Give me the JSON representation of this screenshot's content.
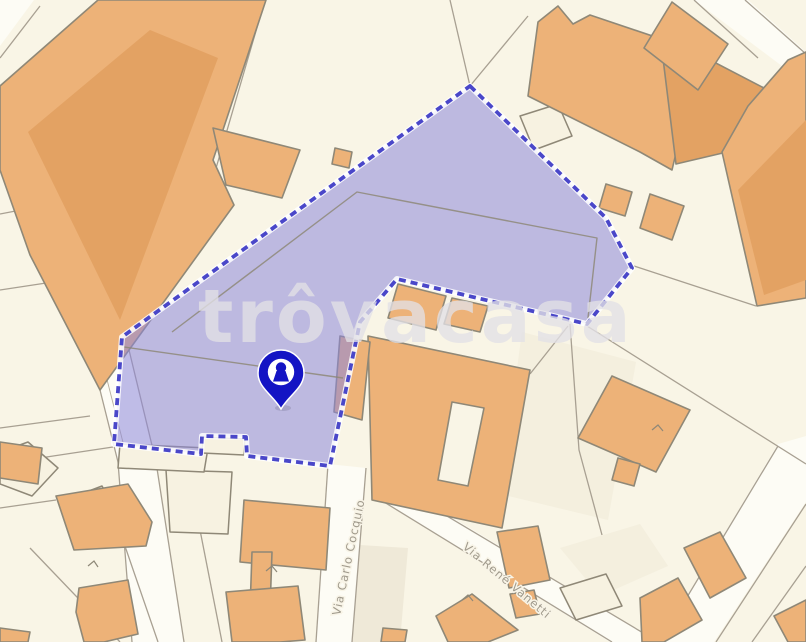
{
  "map": {
    "watermark": {
      "text": "trôvacasa"
    },
    "streets": [
      {
        "name": "Via Carlo Cocquio"
      },
      {
        "name": "Via René Vanetti"
      }
    ],
    "marker": {
      "type": "property-location",
      "icon": "keyhole-icon"
    },
    "parcel": {
      "status": "selected",
      "shape": "dashed-outline"
    },
    "colors": {
      "background": "#f9f5e6",
      "road": "#fdfcf5",
      "building": "#edb278",
      "building_dark": "#e3a263",
      "building_outline": "#8f8877",
      "parcel_line": "#a8a092",
      "parcel_fill": "rgba(140,135,218,0.55)",
      "parcel_border": "#4a47c9",
      "pin": "#1414c4",
      "street_label": "#a09a8c",
      "watermark": "#e3e1e6"
    }
  }
}
